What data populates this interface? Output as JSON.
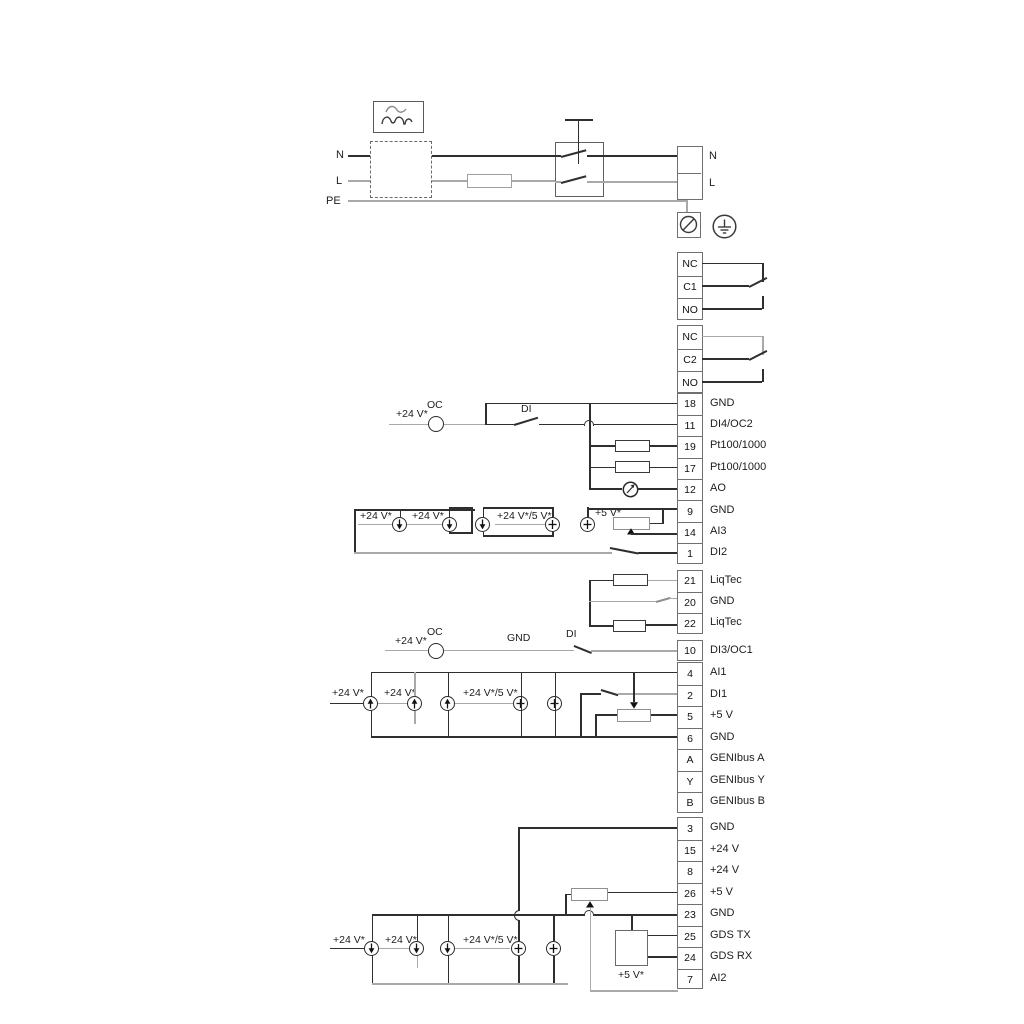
{
  "power": {
    "n": "N",
    "l": "L",
    "pe": "PE",
    "n_out": "N",
    "l_out": "L"
  },
  "relay1": [
    {
      "t": "NC"
    },
    {
      "t": "C1"
    },
    {
      "t": "NO"
    }
  ],
  "relay2": [
    {
      "t": "NC"
    },
    {
      "t": "C2"
    },
    {
      "t": "NO"
    }
  ],
  "io1": [
    {
      "no": "18",
      "label": "GND"
    },
    {
      "no": "11",
      "label": "DI4/OC2"
    },
    {
      "no": "19",
      "label": "Pt100/1000"
    },
    {
      "no": "17",
      "label": "Pt100/1000"
    },
    {
      "no": "12",
      "label": "AO"
    },
    {
      "no": "9",
      "label": "GND"
    },
    {
      "no": "14",
      "label": "AI3"
    },
    {
      "no": "1",
      "label": "DI2"
    }
  ],
  "liqtec": [
    {
      "no": "21",
      "label": "LiqTec"
    },
    {
      "no": "20",
      "label": "GND"
    },
    {
      "no": "22",
      "label": "LiqTec"
    }
  ],
  "di3": [
    {
      "no": "10",
      "label": "DI3/OC1"
    }
  ],
  "io2": [
    {
      "no": "4",
      "label": "AI1"
    },
    {
      "no": "2",
      "label": "DI1"
    },
    {
      "no": "5",
      "label": "+5 V"
    },
    {
      "no": "6",
      "label": "GND"
    },
    {
      "no": "A",
      "label": "GENIbus A"
    },
    {
      "no": "Y",
      "label": "GENIbus Y"
    },
    {
      "no": "B",
      "label": "GENIbus B"
    }
  ],
  "io3": [
    {
      "no": "3",
      "label": "GND"
    },
    {
      "no": "15",
      "label": "+24 V"
    },
    {
      "no": "8",
      "label": "+24 V"
    },
    {
      "no": "26",
      "label": "+5 V"
    },
    {
      "no": "23",
      "label": "GND"
    },
    {
      "no": "25",
      "label": "GDS TX"
    },
    {
      "no": "24",
      "label": "GDS RX"
    },
    {
      "no": "7",
      "label": "AI2"
    }
  ],
  "ann": {
    "oc1_supply": "+24 V*",
    "oc1": "OC",
    "di4": "DI",
    "s1a": "+24 V*",
    "s1b": "+24 V*",
    "s1c": "+24 V*/5 V*",
    "s1d": "+5 V*",
    "oc2_supply": "+24 V*",
    "oc2": "OC",
    "gnd_run": "GND",
    "di3": "DI",
    "s2a": "+24 V*",
    "s2b": "+24 V*",
    "s2c": "+24 V*/5 V*",
    "s3a": "+24 V*",
    "s3b": "+24 V*",
    "s3c": "+24 V*/5 V*",
    "s3d": "+5 V*"
  },
  "colors": {
    "wire": "#2f2f2f",
    "wire_light": "#a9a9a9",
    "box_border": "#707070"
  }
}
